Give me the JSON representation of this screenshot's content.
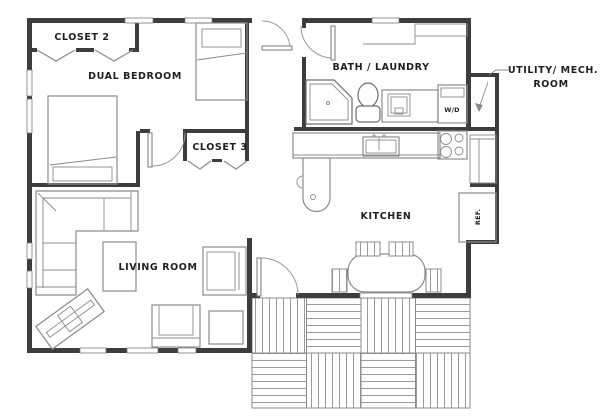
{
  "floor_plan": {
    "labels": {
      "closet2": "CLOSET 2",
      "dual_bedroom": "DUAL BEDROOM",
      "bath_laundry": "BATH / LAUNDRY",
      "utility_line1": "UTILITY/ MECH.",
      "utility_line2": "ROOM",
      "closet3": "CLOSET 3",
      "kitchen": "KITCHEN",
      "living_room": "LIVING ROOM",
      "washer_dryer": "W/D",
      "refrigerator": "REF."
    },
    "colors": {
      "wall": "#3d3d3d",
      "furniture_line": "#8b8b8b",
      "fixture_line": "#6e6e6e",
      "deck_stripe": "#9a9a9a",
      "background": "#ffffff",
      "text": "#1f1f1f"
    }
  }
}
